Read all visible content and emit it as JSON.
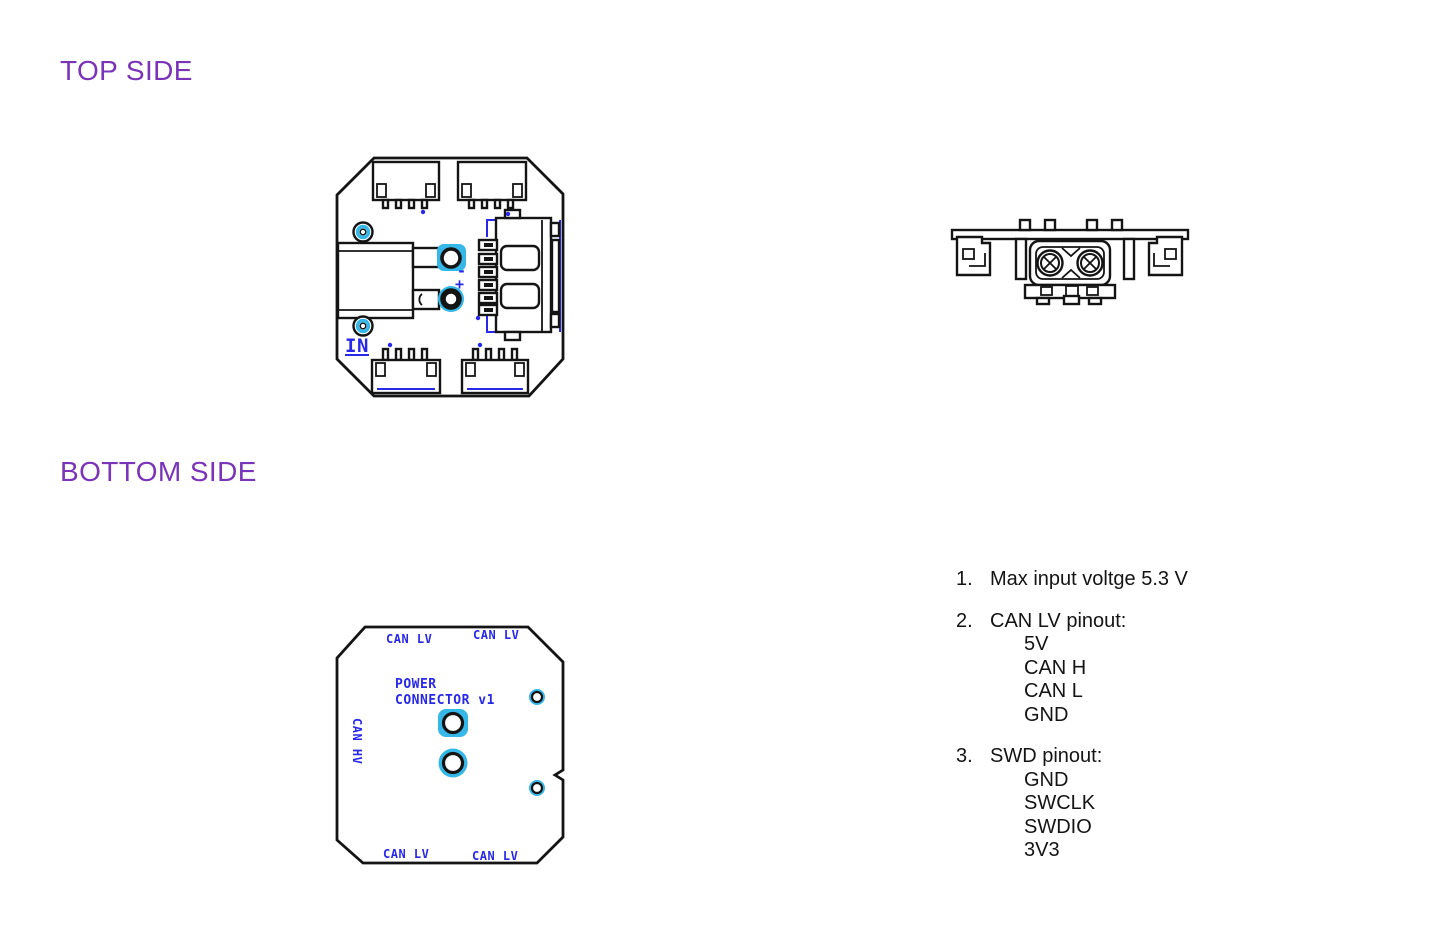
{
  "headings": {
    "top_side": "TOP SIDE",
    "bottom_side": "BOTTOM SIDE"
  },
  "colors": {
    "heading_purple": "#7A34B8",
    "silkscreen_blue": "#2828E8",
    "pad_cyan": "#35B7E8",
    "line_black": "#141414"
  },
  "top_view": {
    "in_label": "IN",
    "minus_label": "-",
    "plus_label": "+"
  },
  "bottom_view": {
    "can_lv_top_left": "CAN LV",
    "can_lv_top_right": "CAN LV",
    "can_lv_bottom_left": "CAN LV",
    "can_lv_bottom_right": "CAN LV",
    "can_hv_left": "CAN HV",
    "power_line1": "POWER",
    "power_line2": "CONNECTOR v1"
  },
  "notes": [
    {
      "num": "1.",
      "title": "Max input voltge 5.3 V",
      "items": []
    },
    {
      "num": "2.",
      "title": "CAN LV pinout:",
      "items": [
        "5V",
        "CAN H",
        "CAN L",
        "GND"
      ]
    },
    {
      "num": "3.",
      "title": "SWD pinout:",
      "items": [
        "GND",
        "SWCLK",
        "SWDIO",
        "3V3"
      ]
    }
  ]
}
